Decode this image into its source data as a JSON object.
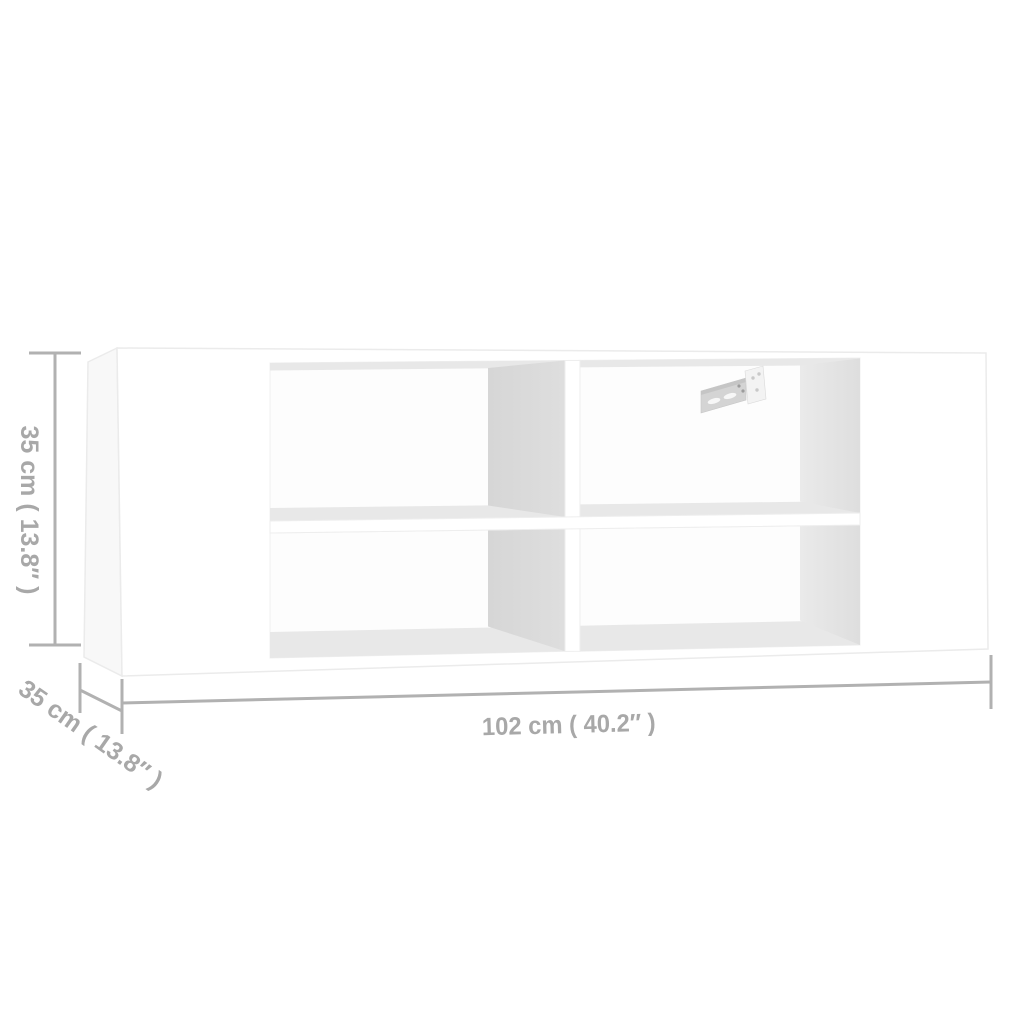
{
  "diagram": {
    "subject": "wall-mounted-tv-shelf",
    "colors": {
      "background": "#ffffff",
      "panel": "#ffffff",
      "side_shade": "#f8f8f8",
      "interior_band": "#e8e8e8",
      "divider_shade": "#d9d9d9",
      "right_wall_shade": "#e1e1e1",
      "dimension_line": "#b1b1b1",
      "dimension_text": "#a8a8a8"
    },
    "dimensions": {
      "height": {
        "cm": "35",
        "inches": "13.8",
        "label": "35 cm ( 13.8″ )"
      },
      "depth": {
        "cm": "35",
        "inches": "13.8",
        "label": "35 cm ( 13.8″ )"
      },
      "width": {
        "cm": "102",
        "inches": "40.2",
        "label": "102 cm ( 40.2″ )"
      }
    }
  }
}
